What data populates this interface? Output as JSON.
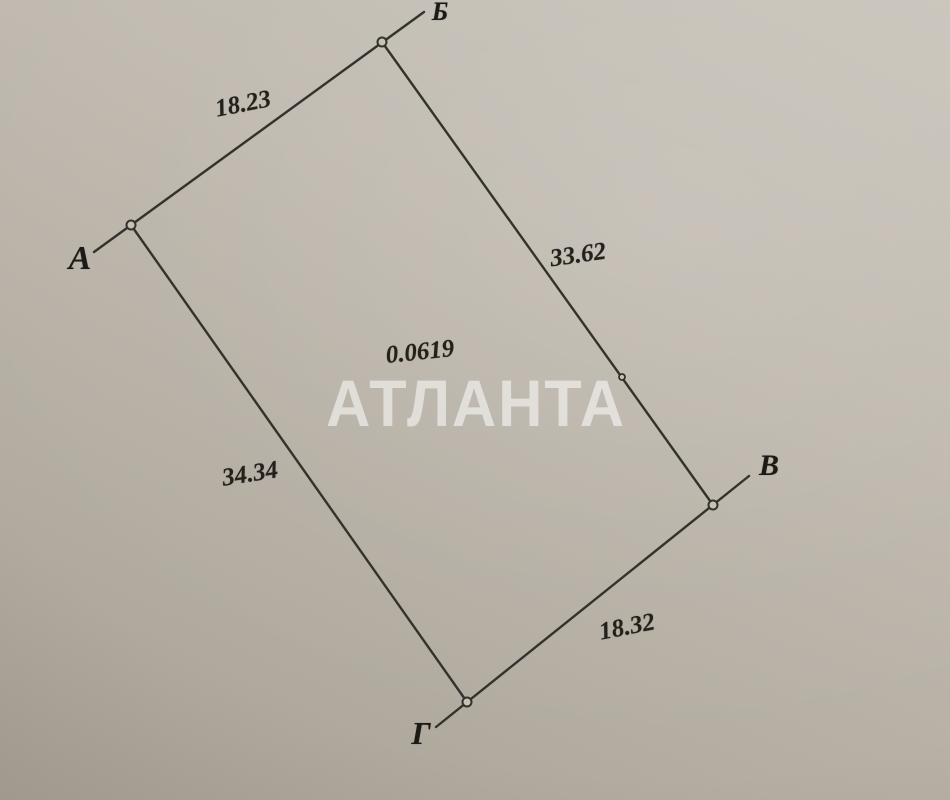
{
  "photo": {
    "watermark": "АТЛАНТА"
  },
  "plot": {
    "area": "0.0619",
    "corners": [
      {
        "label": "А"
      },
      {
        "label": "Б"
      },
      {
        "label": "В"
      },
      {
        "label": "Г"
      }
    ],
    "sides": [
      {
        "from": "А",
        "to": "Б",
        "length": "18.23"
      },
      {
        "from": "Б",
        "to": "В",
        "length": "33.62"
      },
      {
        "from": "В",
        "to": "Г",
        "length": "18.32"
      },
      {
        "from": "Г",
        "to": "А",
        "length": "34.34"
      }
    ]
  }
}
